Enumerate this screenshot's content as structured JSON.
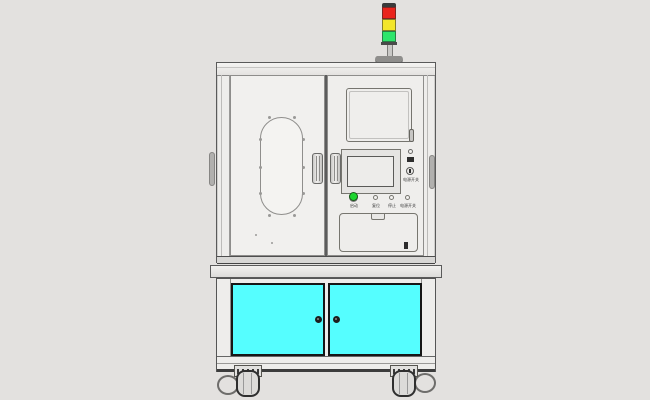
{
  "colors": {
    "bg": "#e3e1df",
    "body": "#eeedeb",
    "cyan": "#55feff",
    "red": "#ea241c",
    "yellow": "#f3e62a",
    "green": "#2ee56b",
    "btn_green": "#1dd52f"
  },
  "tower": {
    "lights": [
      "red",
      "yellow",
      "green"
    ]
  },
  "control_panel": {
    "power_switch_label": "电源开关",
    "buttons": [
      {
        "label": "启动",
        "type": "green-illuminated"
      },
      {
        "label": "复位",
        "type": "round"
      },
      {
        "label": "停止",
        "type": "round"
      },
      {
        "label": "电源开关",
        "type": "round"
      }
    ]
  }
}
